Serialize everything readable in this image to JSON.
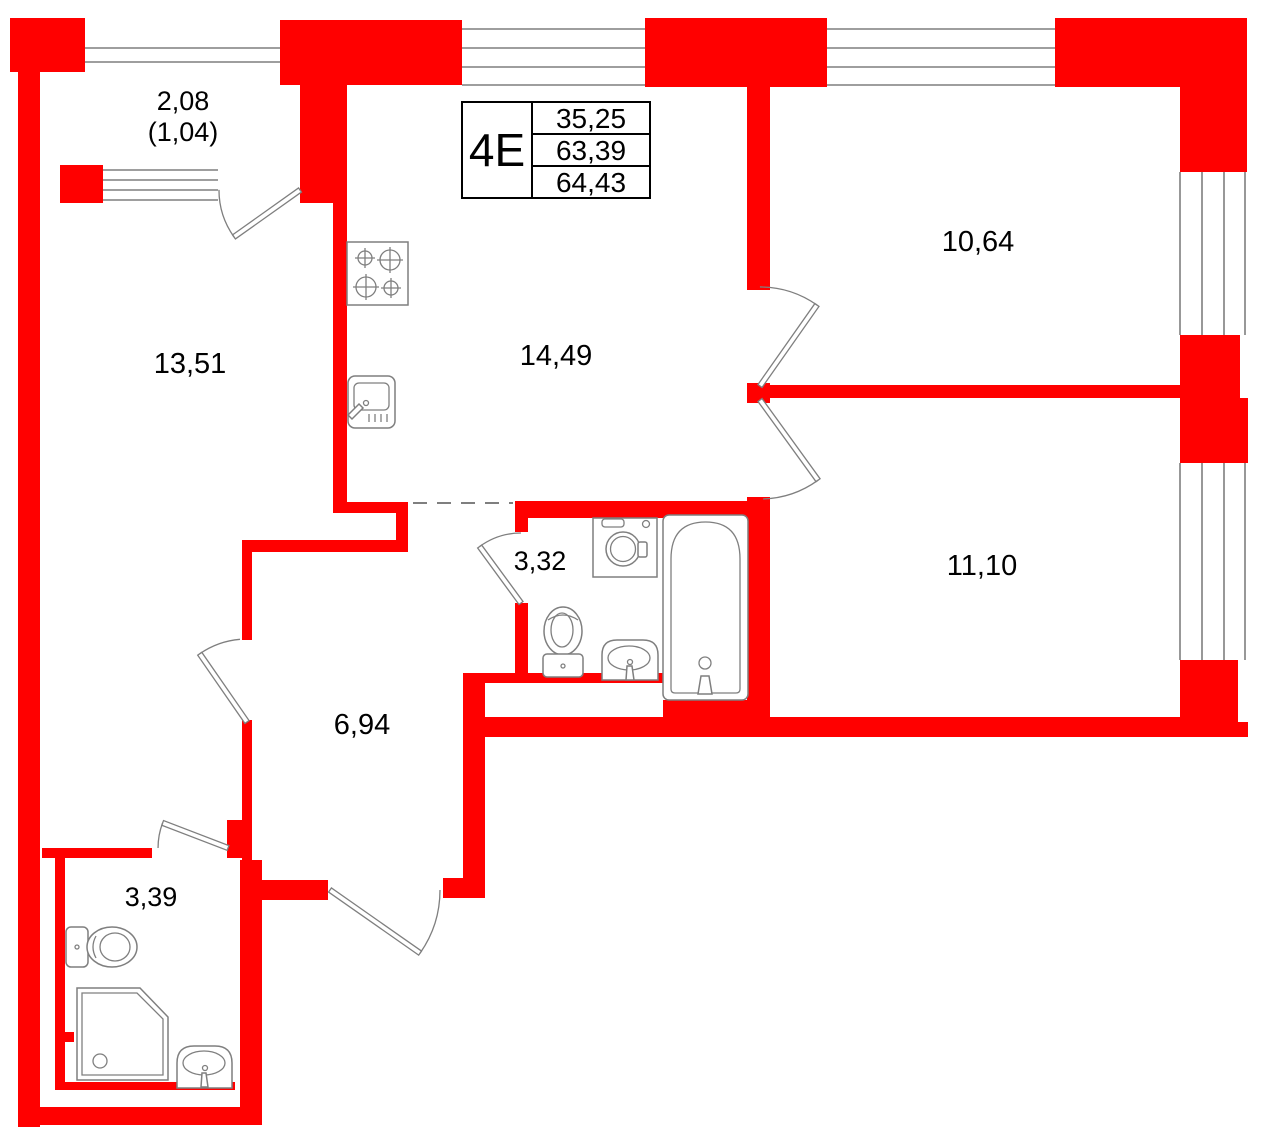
{
  "title_block": {
    "unit": "4Е",
    "rows": [
      "35,25",
      "63,39",
      "64,43"
    ]
  },
  "rooms": {
    "balcony": {
      "area": "2,08",
      "area_secondary": "(1,04)"
    },
    "living_room": {
      "area": "13,51"
    },
    "kitchen": {
      "area": "14,49"
    },
    "bedroom_top": {
      "area": "10,64"
    },
    "bedroom_bottom": {
      "area": "11,10"
    },
    "bathroom": {
      "area": "3,32"
    },
    "hall": {
      "area": "6,94"
    },
    "wc": {
      "area": "3,39"
    }
  },
  "fixtures": [
    "stove-icon",
    "kitchen-sink-icon",
    "washing-machine-icon",
    "toilet-icon",
    "bathroom-sink-icon",
    "bathtub-icon",
    "wc-toilet-icon",
    "shower-icon",
    "wc-sink-icon"
  ],
  "colors": {
    "wall": "#ff0000",
    "line": "#7f7f7f",
    "text": "#000000",
    "background": "#ffffff"
  }
}
